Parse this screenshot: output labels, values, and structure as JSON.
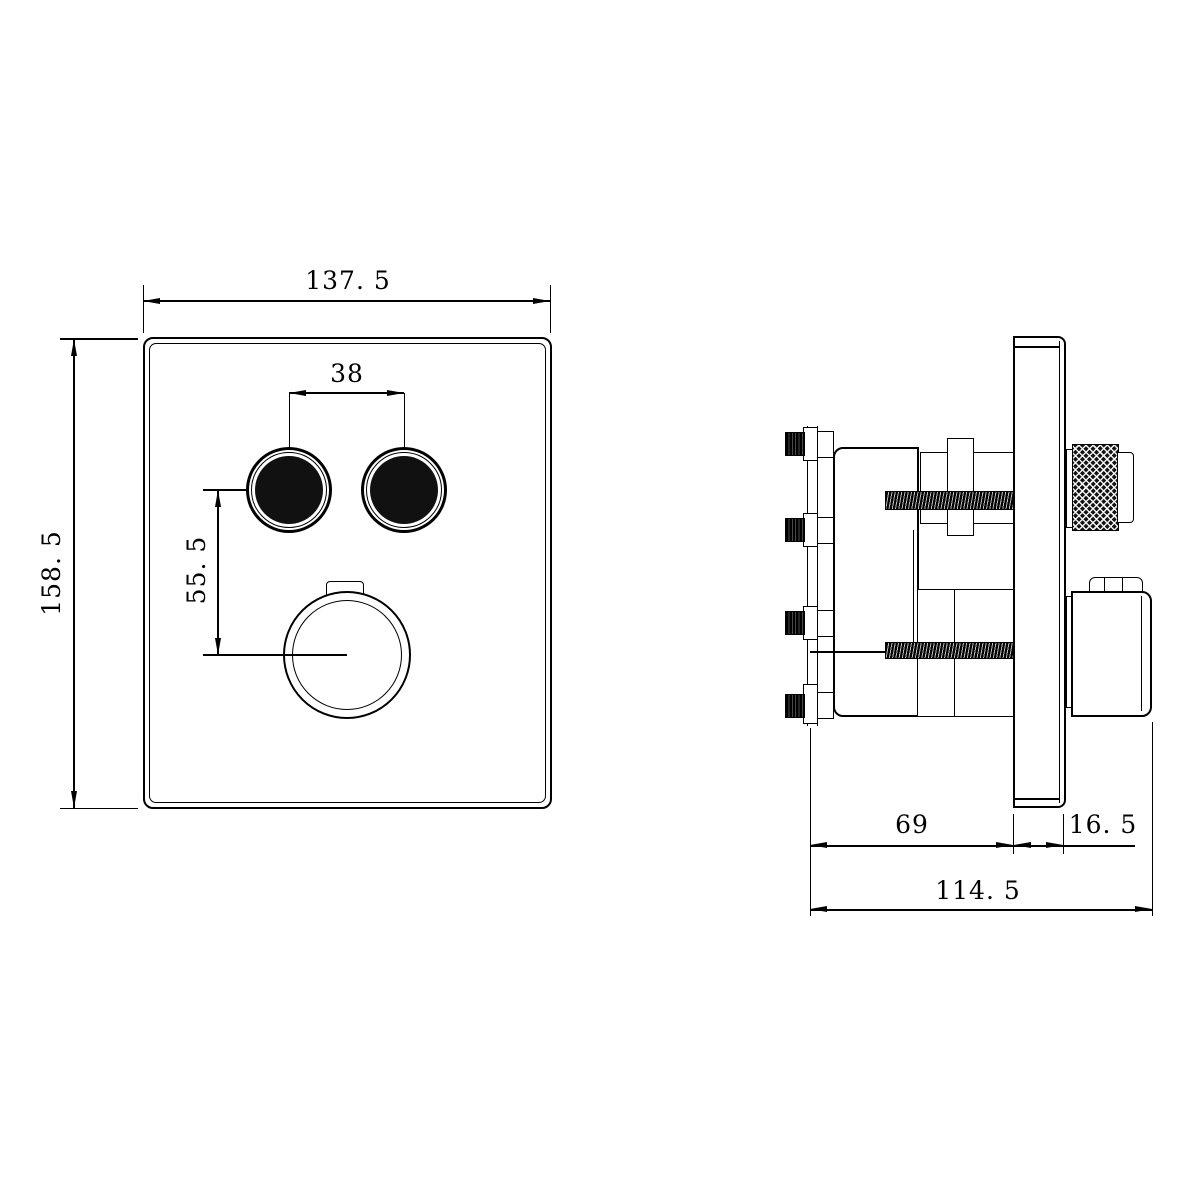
{
  "colors": {
    "line": "#000000",
    "background": "#ffffff",
    "fill": "#111111"
  },
  "front_view": {
    "width_label": "137. 5",
    "height_label": "158. 5",
    "button_spacing_label": "38",
    "button_to_knob_spacing_label": "55. 5"
  },
  "side_view": {
    "valve_body_depth_label": "69",
    "trim_plate_thickness_label": "16. 5",
    "total_depth_label": "114. 5"
  }
}
